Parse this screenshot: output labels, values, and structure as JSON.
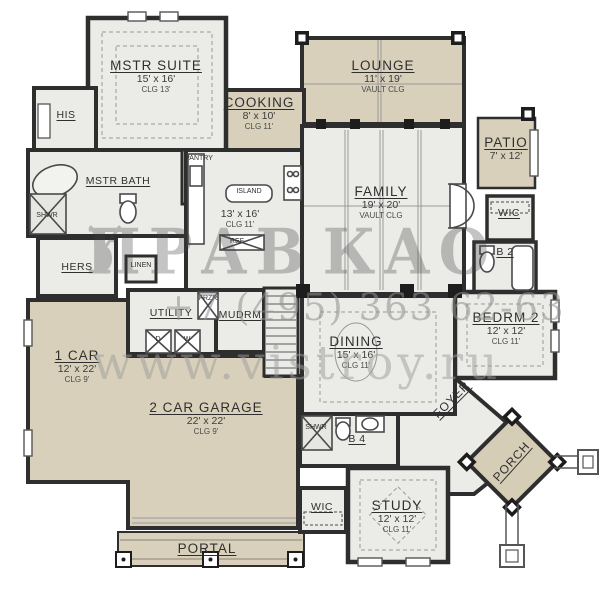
{
  "watermark": {
    "logo_left": "ПРАВ",
    "logo_right": "КАО",
    "deer_icon": "deer-silhouette",
    "phone": "+7 (495) 363 62-63",
    "site": "www.vistroy.ru"
  },
  "colors": {
    "outdoor_fill": "#d8d0ba",
    "interior_fill": "#ebebe8",
    "wall": "#2e2e2e"
  },
  "rooms": {
    "mstr_suite": {
      "name": "MSTR SUITE",
      "dim": "15' x 16'",
      "clg": "CLG 13'"
    },
    "his": {
      "name": "HIS"
    },
    "cooking": {
      "name": "COOKING",
      "dim": "8' x 10'",
      "clg": "CLG 11'"
    },
    "lounge": {
      "name": "LOUNGE",
      "dim": "11' x 19'",
      "clg": "VAULT CLG"
    },
    "patio": {
      "name": "PATIO",
      "dim": "7' x 12'"
    },
    "mstr_bath": {
      "name": "MSTR BATH"
    },
    "shwr_mstr": {
      "name": "SHWR"
    },
    "pantry": {
      "name": "PANTRY"
    },
    "hers": {
      "name": "HERS"
    },
    "linen": {
      "name": "LINEN"
    },
    "island": {
      "name": "ISLAND"
    },
    "kitchen": {
      "dim": "13' x 16'",
      "clg": "CLG 11'"
    },
    "ref": {
      "name": "REF"
    },
    "family": {
      "name": "FAMILY",
      "dim": "19' x 20'",
      "clg": "VAULT CLG"
    },
    "wic_right": {
      "name": "WIC"
    },
    "b2": {
      "name": "B 2"
    },
    "bedrm2": {
      "name": "BEDRM 2",
      "dim": "12' x 12'",
      "clg": "CLG 11'"
    },
    "utility": {
      "name": "UTILITY"
    },
    "frzr": {
      "name": "FRZR"
    },
    "mudrm": {
      "name": "MUDRM"
    },
    "dryer": {
      "name": "D"
    },
    "washer": {
      "name": "W"
    },
    "one_car": {
      "name": "1 CAR",
      "dim": "12' x 22'",
      "clg": "CLG 9'"
    },
    "garage": {
      "name": "2 CAR GARAGE",
      "dim": "22' x 22'",
      "clg": "CLG 9'"
    },
    "dining": {
      "name": "DINING",
      "dim": "15' x 16'",
      "clg": "CLG 11'"
    },
    "foyer": {
      "name": "FOYER"
    },
    "b4": {
      "name": "B 4"
    },
    "shwr_b4": {
      "name": "SHWR"
    },
    "wic_study": {
      "name": "WIC"
    },
    "study": {
      "name": "STUDY",
      "dim": "12' x 12'",
      "clg": "CLG 11'"
    },
    "porch": {
      "name": "PORCH"
    },
    "portal": {
      "name": "PORTAL"
    }
  }
}
